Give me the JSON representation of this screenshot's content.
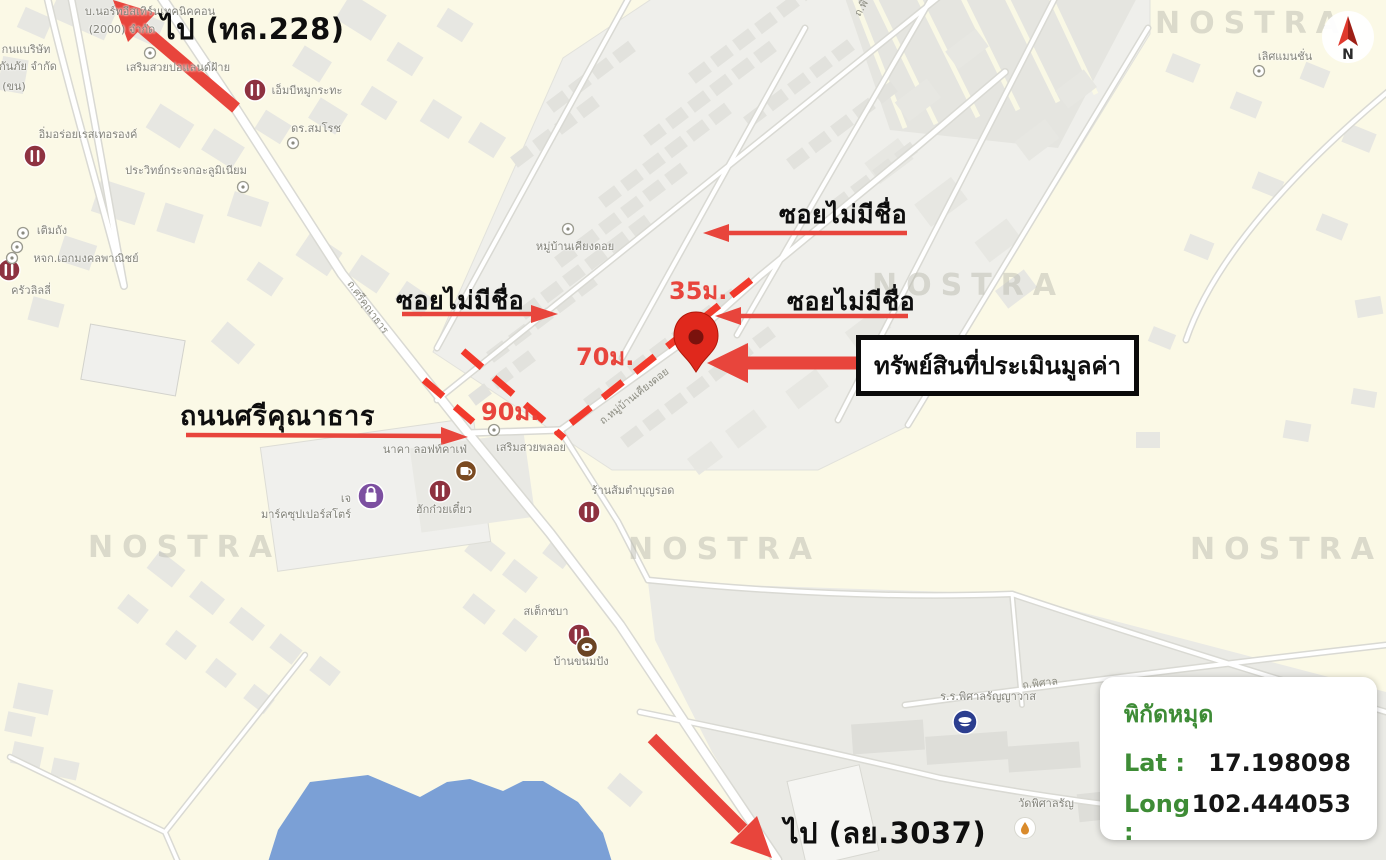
{
  "annotations": {
    "direction_top_label": "ไป (ทล.228)",
    "direction_bottom_label": "ไป (ลย.3037)",
    "soi_label_top": "ซอยไม่มีชื่อ",
    "soi_label_mid": "ซอยไม่มีชื่อ",
    "soi_label_left": "ซอยไม่มีชื่อ",
    "main_road_label": "ถนนศรีคุณาธาร",
    "property_box_label": "ทรัพย์สินที่ประเมินมูลค่า",
    "dist_35": "35ม.",
    "dist_70": "70ม.",
    "dist_90": "90ม."
  },
  "coords_panel": {
    "title": "พิกัดหมุด",
    "lat_label": "Lat :",
    "lat_value": "17.198098",
    "long_label": "Long :",
    "long_value": "102.444053"
  },
  "compass": {
    "letter": "N"
  },
  "colors": {
    "annotation_red": "#E8453C",
    "dash_red": "#F2392B",
    "pin_red": "#E0281C",
    "coord_green": "#3E8C36",
    "water_blue": "#7BA0D6",
    "background_cream": "#FBF9E6"
  },
  "map": {
    "watermark_text": "NOSTRA",
    "watermarks": [
      {
        "x": 88,
        "y": 530
      },
      {
        "x": 628,
        "y": 532
      },
      {
        "x": 1190,
        "y": 532
      },
      {
        "x": 872,
        "y": 268
      },
      {
        "x": 1155,
        "y": 6
      }
    ],
    "poi_labels": [
      {
        "text": "บ.นอร์ทอีสเทิร์นเทคนิคคอน",
        "x": 150,
        "y": 2
      },
      {
        "text": "(2000) จำกัด",
        "x": 122,
        "y": 20
      },
      {
        "text": "กนแบริษัท",
        "x": 26,
        "y": 40
      },
      {
        "text": "กันภัย จำกัด",
        "x": 28,
        "y": 57
      },
      {
        "text": "(ขน)",
        "x": 14,
        "y": 77
      },
      {
        "text": "เสริมสวยปอแลนด์ฝ้าย",
        "x": 178,
        "y": 58
      },
      {
        "text": "เอ็มบีหมูกระทะ",
        "x": 307,
        "y": 81
      },
      {
        "text": "ดร.สมโรช",
        "x": 316,
        "y": 119
      },
      {
        "text": "อิ่มอร่อยเรสเทอรองค์",
        "x": 88,
        "y": 125
      },
      {
        "text": "ประวิทย์กระจกอะลูมิเนียม",
        "x": 186,
        "y": 161
      },
      {
        "text": "เติมถัง",
        "x": 52,
        "y": 221
      },
      {
        "text": "หจก.เอกมงคลพาณิชย์",
        "x": 86,
        "y": 249
      },
      {
        "text": "ครัวลิลลี่",
        "x": 31,
        "y": 281
      },
      {
        "text": "หมู่บ้านเคียงดอย",
        "x": 575,
        "y": 237
      },
      {
        "text": "เสริมสวยพลอย",
        "x": 531,
        "y": 438
      },
      {
        "text": "นาคา ลอฟท์คาเฟ่",
        "x": 425,
        "y": 440
      },
      {
        "text": "มาร์คซุปเปอร์สโตร์",
        "x": 306,
        "y": 505
      },
      {
        "text": "เจ",
        "x": 346,
        "y": 489
      },
      {
        "text": "ฮักก๋วยเตี๋ยว",
        "x": 444,
        "y": 500
      },
      {
        "text": "ร้านส้มตำบุญรอด",
        "x": 633,
        "y": 481
      },
      {
        "text": "สเต็กชบา",
        "x": 546,
        "y": 602
      },
      {
        "text": "บ้านขนมปัง",
        "x": 581,
        "y": 652
      },
      {
        "text": "ร.ร.พิศาลรัญญาวาส",
        "x": 988,
        "y": 687
      },
      {
        "text": "วัดพิศาลรัญ",
        "x": 1046,
        "y": 794
      },
      {
        "text": "เลิศแมนชั่น",
        "x": 1285,
        "y": 47
      }
    ],
    "road_labels": [
      {
        "text": "ถ.ศรีคุณาธาร",
        "x": 368,
        "y": 307,
        "rot": 54
      },
      {
        "text": "ถ.หมู่บ้านเคียงดอย",
        "x": 634,
        "y": 396,
        "rot": -38
      },
      {
        "text": "ถ.พิศาล",
        "x": 1040,
        "y": 683,
        "rot": -7
      },
      {
        "text": "ถ.พิ",
        "x": 861,
        "y": 8,
        "rot": -60
      }
    ],
    "icons": [
      {
        "type": "restaurant",
        "x": 255,
        "y": 90
      },
      {
        "type": "restaurant",
        "x": 35,
        "y": 156
      },
      {
        "type": "restaurant",
        "x": 9,
        "y": 270
      },
      {
        "type": "restaurant",
        "x": 440,
        "y": 491
      },
      {
        "type": "restaurant",
        "x": 589,
        "y": 512
      },
      {
        "type": "restaurant",
        "x": 579,
        "y": 635
      },
      {
        "type": "coffee",
        "x": 466,
        "y": 471
      },
      {
        "type": "bread",
        "x": 587,
        "y": 647
      },
      {
        "type": "bag",
        "x": 371,
        "y": 496
      },
      {
        "type": "school",
        "x": 965,
        "y": 722
      },
      {
        "type": "temple",
        "x": 1025,
        "y": 828
      },
      {
        "type": "dot",
        "x": 150,
        "y": 53
      },
      {
        "type": "dot",
        "x": 293,
        "y": 143
      },
      {
        "type": "dot",
        "x": 243,
        "y": 187
      },
      {
        "type": "dot",
        "x": 23,
        "y": 233
      },
      {
        "type": "dot",
        "x": 17,
        "y": 247
      },
      {
        "type": "dot",
        "x": 12,
        "y": 258
      },
      {
        "type": "dot",
        "x": 568,
        "y": 229
      },
      {
        "type": "dot",
        "x": 494,
        "y": 430
      },
      {
        "type": "dot",
        "x": 1259,
        "y": 71
      }
    ]
  }
}
